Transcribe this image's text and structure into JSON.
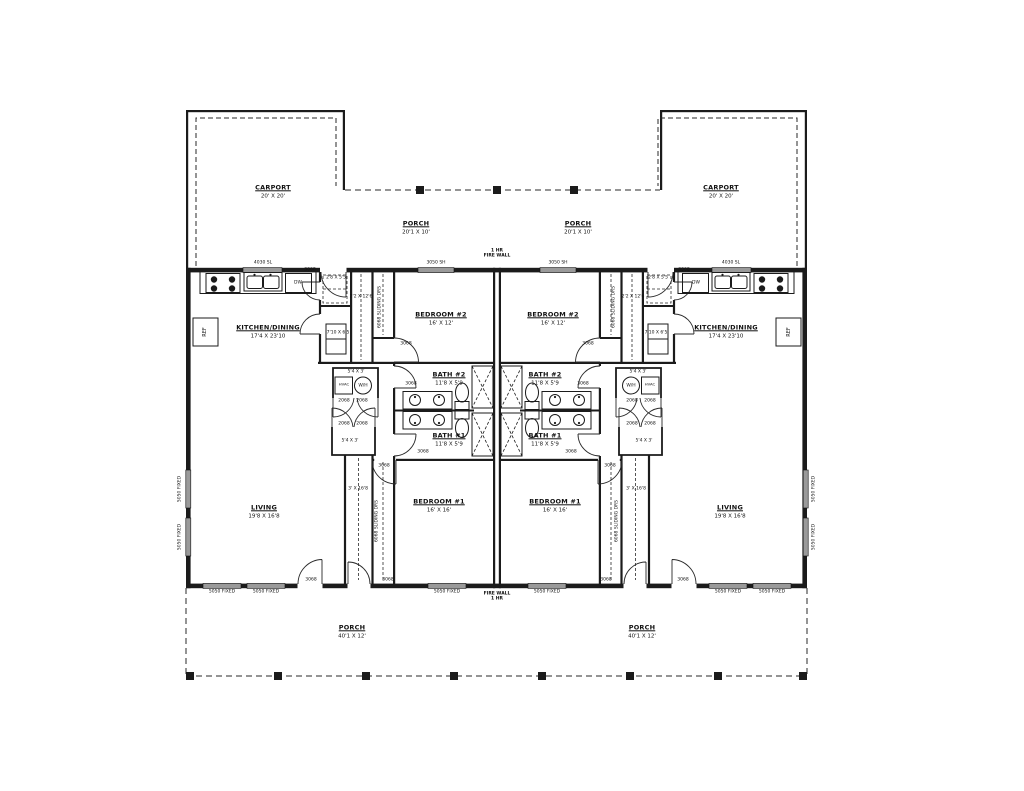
{
  "rooms": {
    "carport": {
      "name": "CARPORT",
      "dims": "20' X 20'"
    },
    "porch_upper": {
      "name": "PORCH",
      "dims": "20'1 X 10'"
    },
    "kitchen": {
      "name": "KITCHEN/DINING",
      "dims": "17'4 X 23'10"
    },
    "bedroom2": {
      "name": "BEDROOM  #2",
      "dims": "16' X 12'"
    },
    "bath2": {
      "name": "BATH  #2",
      "dims": "11'8 X 5'9"
    },
    "bath1": {
      "name": "BATH  #1",
      "dims": "11'8 X 5'9"
    },
    "bedroom1": {
      "name": "BEDROOM  #1",
      "dims": "16' X 16'"
    },
    "living": {
      "name": "LIVING",
      "dims": "19'8 X 16'8"
    },
    "porch_lower": {
      "name": "PORCH",
      "dims": "40'1 X 12'"
    }
  },
  "spaces": {
    "pantry_dims": "2'8 X 5'5",
    "chase_dims": "2'2 X 12'6",
    "utility_dims": "7'10 X 6'5",
    "wh_closet_dims": "5'4 X 3'",
    "hall_closet_dims": "5'4 X 3'",
    "hall_dims": "3' X 16'8"
  },
  "equipment": {
    "water_heater": "W/H",
    "hvac": "HVAC",
    "dishwasher": "DW",
    "refrigerator": "REF"
  },
  "windows": {
    "kitchen": "4030 SL",
    "bedroom": "3050 SH",
    "fixed": "5050 FIXED"
  },
  "doors": {
    "swing": "3068",
    "closet": "2068",
    "sliding": "6068 SLIDING DRS"
  },
  "firewall": {
    "top_line1": "1 HR",
    "top_line2": "FIRE WALL",
    "bottom_line1": "FIRE WALL",
    "bottom_line2": "1 HR"
  }
}
